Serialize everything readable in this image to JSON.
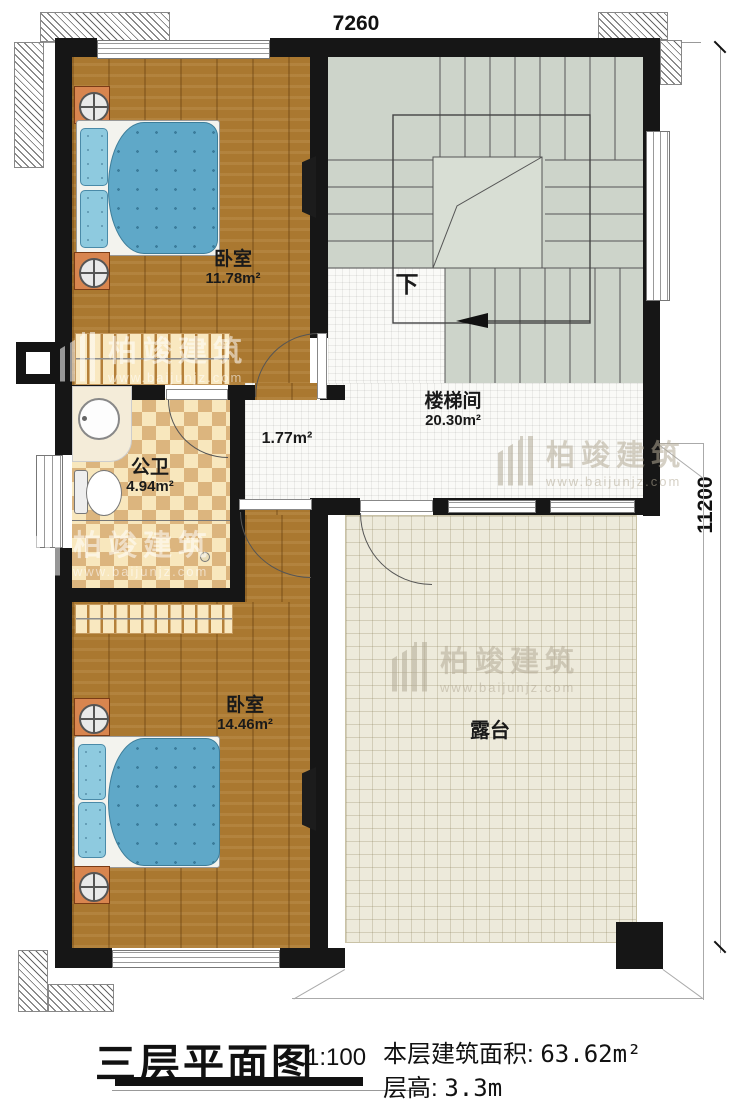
{
  "title_block": {
    "title": "三层平面图",
    "scale": "1:100",
    "area_label": "本层建筑面积:",
    "area_value": "63.62m²",
    "floor_height_label": "层高:",
    "floor_height_value": "3.3m"
  },
  "dimensions": {
    "top_width": "7260",
    "right_height": "11200"
  },
  "rooms": {
    "bedroom_top": {
      "name": "卧室",
      "area": "11.78m²"
    },
    "stairwell": {
      "name": "楼梯间",
      "area": "20.30m²"
    },
    "bathroom": {
      "name": "公卫",
      "area": "4.94m²"
    },
    "hallway": {
      "area": "1.77m²"
    },
    "bedroom_bottom": {
      "name": "卧室",
      "area": "14.46m²"
    },
    "terrace": {
      "name": "露台"
    }
  },
  "annotations": {
    "stair_direction": "下"
  },
  "watermark": {
    "brand": "柏竣建筑",
    "url": "www.baijunjz.com"
  },
  "colors": {
    "wall": "#161616",
    "wood_floor": "#aa7830",
    "stair_floor": "#cdd4ca",
    "bathroom_tile": "#dcb57e",
    "terrace_tile": "#edeadb",
    "bed_quilt": "#5fa8c8"
  }
}
